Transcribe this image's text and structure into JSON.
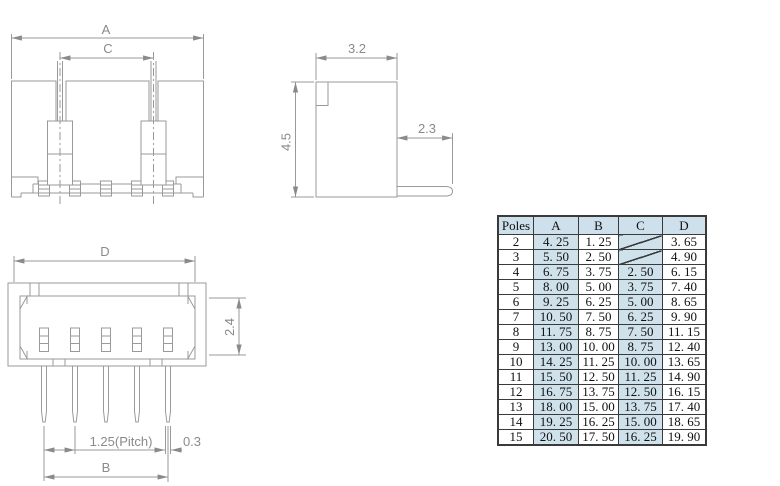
{
  "drawings": {
    "front_view": {
      "labels": {
        "a": "A",
        "c": "C"
      }
    },
    "side_view": {
      "labels": {
        "width": "3.2",
        "height": "4.5",
        "pin_length": "2.3"
      }
    },
    "bottom_view": {
      "labels": {
        "d": "D",
        "height": "2.4",
        "pitch": "1.25(Pitch)",
        "pin_width": "0.3",
        "b": "B"
      }
    }
  },
  "table": {
    "headers": [
      "Poles",
      "A",
      "B",
      "C",
      "D"
    ],
    "highlight_columns": [
      1,
      3
    ],
    "rows": [
      [
        "2",
        "4. 25",
        "1. 25",
        null,
        "3. 65"
      ],
      [
        "3",
        "5. 50",
        "2. 50",
        null,
        "4. 90"
      ],
      [
        "4",
        "6. 75",
        "3. 75",
        "2. 50",
        "6. 15"
      ],
      [
        "5",
        "8. 00",
        "5. 00",
        "3. 75",
        "7. 40"
      ],
      [
        "6",
        "9. 25",
        "6. 25",
        "5. 00",
        "8. 65"
      ],
      [
        "7",
        "10. 50",
        "7. 50",
        "6. 25",
        "9. 90"
      ],
      [
        "8",
        "11. 75",
        "8. 75",
        "7. 50",
        "11. 15"
      ],
      [
        "9",
        "13. 00",
        "10. 00",
        "8. 75",
        "12. 40"
      ],
      [
        "10",
        "14. 25",
        "11. 25",
        "10. 00",
        "13. 65"
      ],
      [
        "11",
        "15. 50",
        "12. 50",
        "11. 25",
        "14. 90"
      ],
      [
        "12",
        "16. 75",
        "13. 75",
        "12. 50",
        "16. 15"
      ],
      [
        "13",
        "18. 00",
        "15. 00",
        "13. 75",
        "17. 40"
      ],
      [
        "14",
        "19. 25",
        "16. 25",
        "15. 00",
        "18. 65"
      ],
      [
        "15",
        "20. 50",
        "17. 50",
        "16. 25",
        "19. 90"
      ]
    ],
    "colors": {
      "header_bg": "#cde0eb",
      "highlight_bg": "#cfe2ec",
      "border": "#3a3a3a",
      "text": "#111111"
    }
  },
  "colors": {
    "background": "#ffffff",
    "drawing_line": "#9a9a9a",
    "dimension_text": "#8a8a8a"
  }
}
